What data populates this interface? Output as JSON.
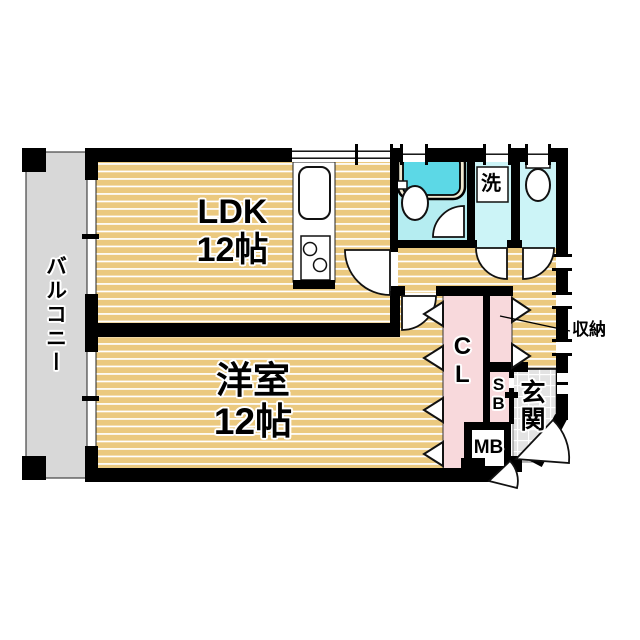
{
  "plan": {
    "labels": {
      "balcony": "バルコニー",
      "ldk_line1": "LDK",
      "ldk_line2": "12帖",
      "western_line1": "洋室",
      "western_line2": "12帖",
      "closet": "CL",
      "storage": "収納",
      "washroom": "洗",
      "entrance": "玄関",
      "shoe_box": "SB",
      "meter_box": "MB"
    },
    "colors": {
      "floor_wood": "#ebc97f",
      "floor_stripe": "#ffffff",
      "balcony_gray": "#d8d8d8",
      "bath_floor": "#b5edf1",
      "sanitary_floor": "#ccf4f7",
      "bathtub_fill": "#5cd8e6",
      "tub_rim": "#f1ead2",
      "closet_pink": "#f8d9dc",
      "entrance_tile": "#e3e3e3",
      "wall_black": "#000000"
    },
    "fixtures": [
      "kitchen-sink",
      "stove",
      "bathtub",
      "washbasin",
      "toilet",
      "washing-machine-pan"
    ]
  }
}
